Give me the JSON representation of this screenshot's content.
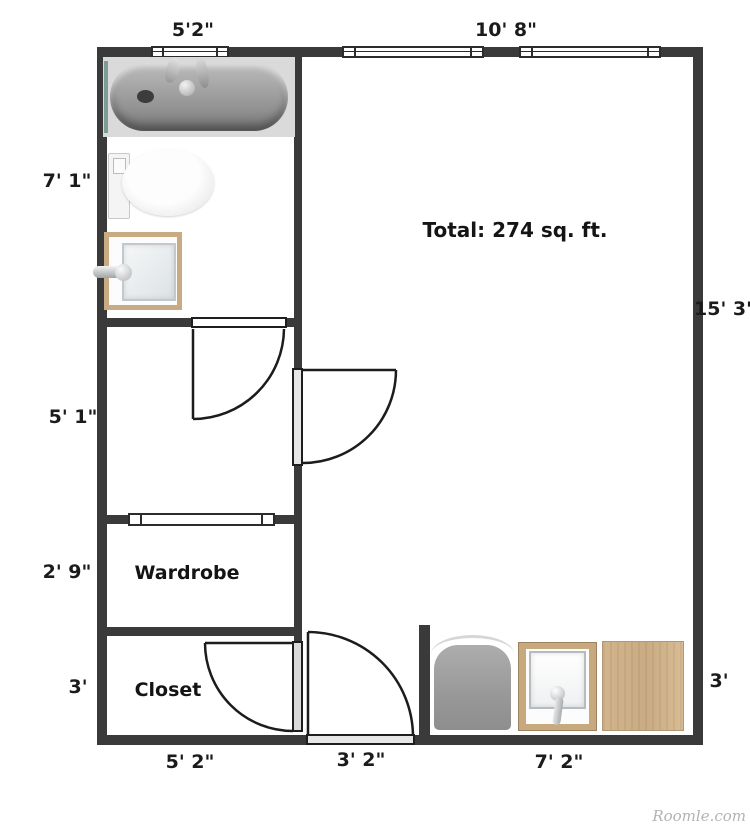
{
  "labels": {
    "total": "Total: 274 sq. ft.",
    "watermark": "Roomle.com"
  },
  "rooms": {
    "wardrobe": "Wardrobe",
    "closet": "Closet"
  },
  "dimensions": {
    "top_bathroom_window": "5'2\"",
    "top_main_windows": "10' 8\"",
    "left_bathroom": "7' 1\"",
    "left_hall": "5' 1\"",
    "left_wardrobe": "2' 9\"",
    "left_closet": "3'",
    "right_main": "15' 3\"",
    "right_utility": "3'",
    "bottom_closet": "5' 2\"",
    "bottom_entry": "3' 2\"",
    "bottom_utility": "7' 2\""
  }
}
